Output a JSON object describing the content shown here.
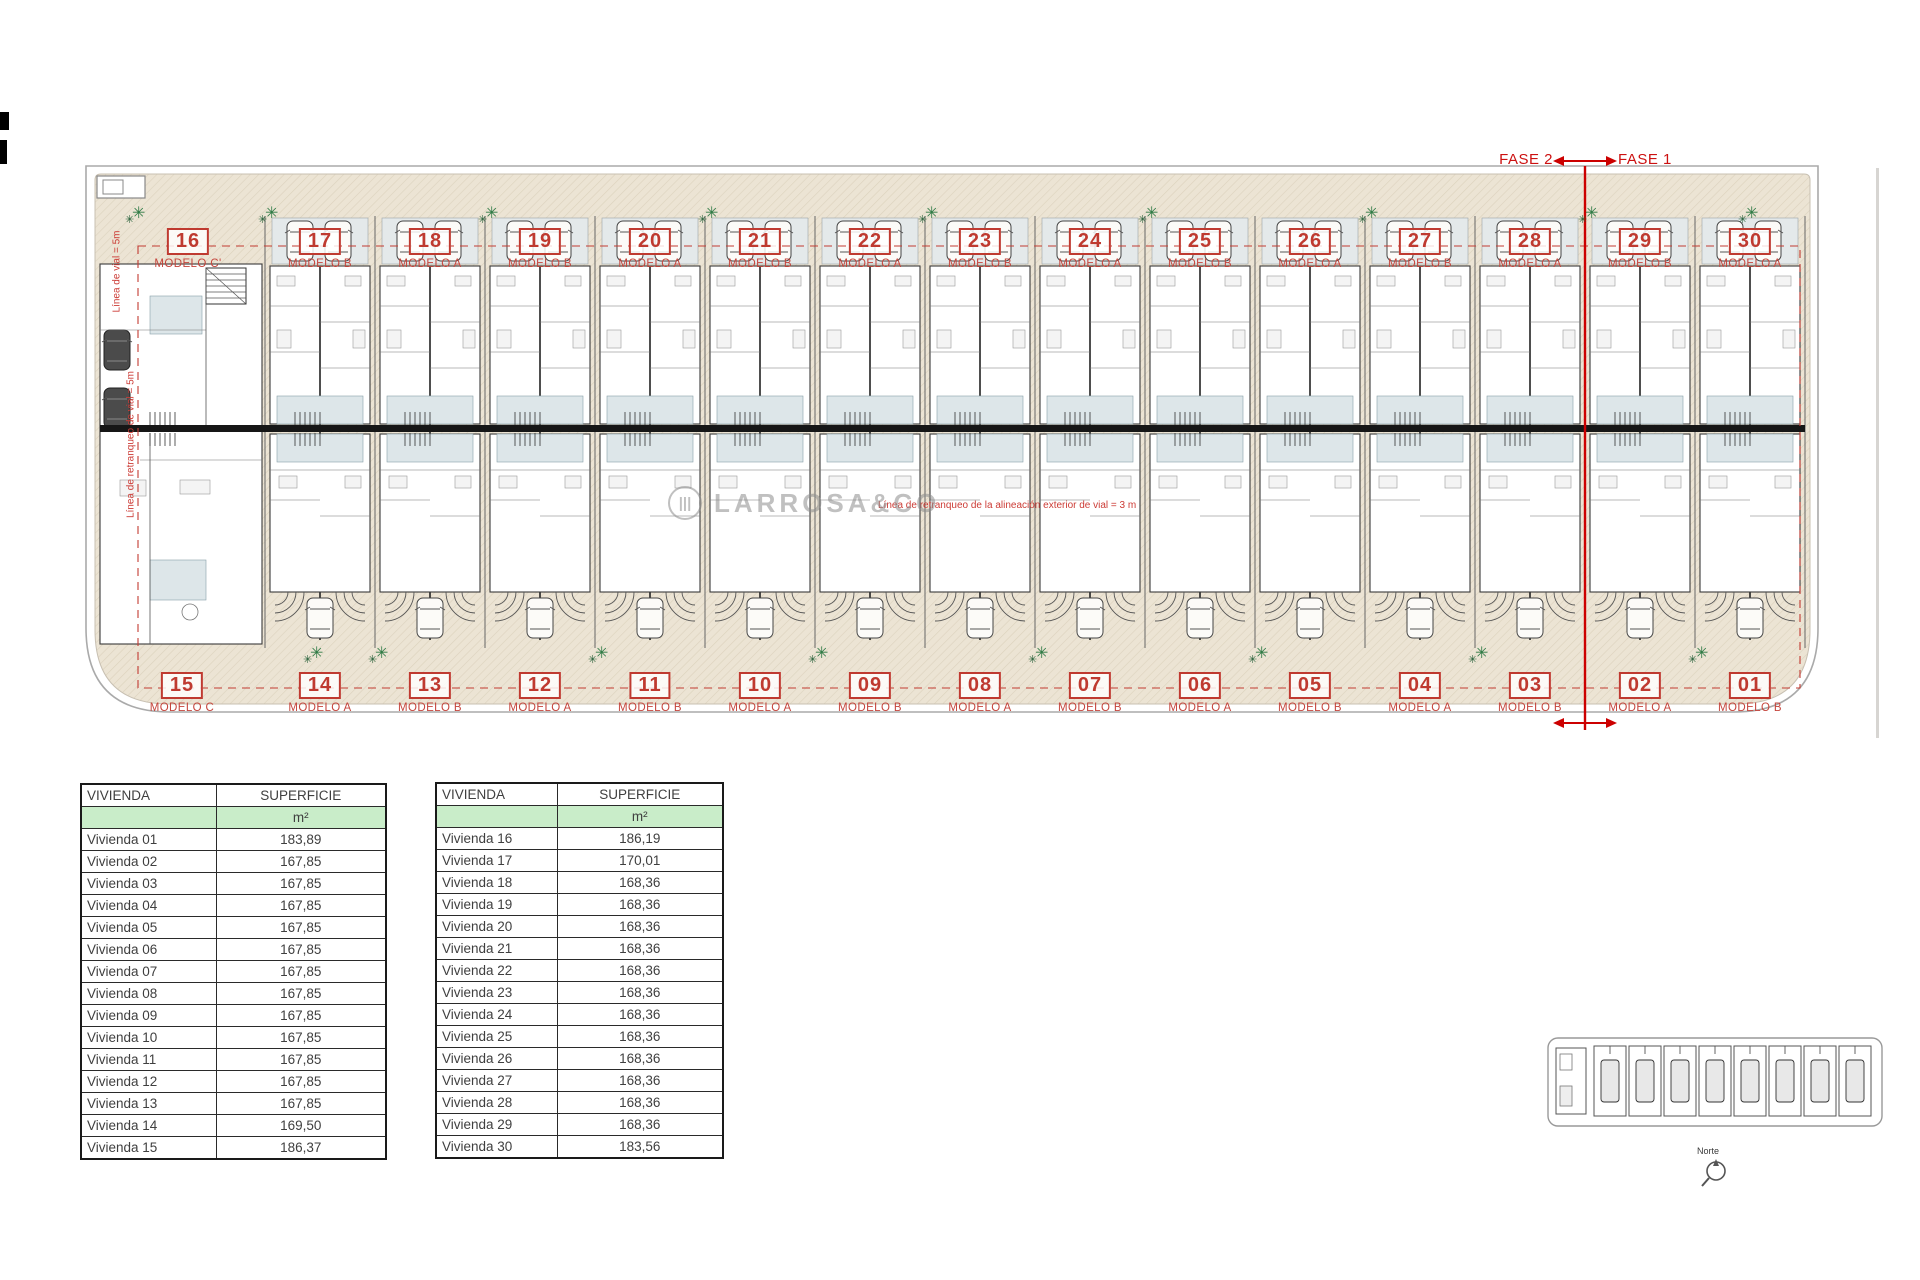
{
  "fase": {
    "left": "FASE 2",
    "right": "FASE 1"
  },
  "annotations": {
    "vial_top": "Línea de vial = 5m",
    "vial_left": "Línea de retranqueo de vial = 5m",
    "vial_mid": "Línea de retranqueo de la alineación exterior de vial = 3 m"
  },
  "watermark": {
    "text": "LARROSA&CO",
    "logo": "circle-logo"
  },
  "plan": {
    "top_units": [
      {
        "num": "16",
        "modelo": "MODELO C'"
      },
      {
        "num": "17",
        "modelo": "MODELO B"
      },
      {
        "num": "18",
        "modelo": "MODELO A"
      },
      {
        "num": "19",
        "modelo": "MODELO B"
      },
      {
        "num": "20",
        "modelo": "MODELO A"
      },
      {
        "num": "21",
        "modelo": "MODELO B"
      },
      {
        "num": "22",
        "modelo": "MODELO A"
      },
      {
        "num": "23",
        "modelo": "MODELO B"
      },
      {
        "num": "24",
        "modelo": "MODELO A"
      },
      {
        "num": "25",
        "modelo": "MODELO B"
      },
      {
        "num": "26",
        "modelo": "MODELO A"
      },
      {
        "num": "27",
        "modelo": "MODELO B"
      },
      {
        "num": "28",
        "modelo": "MODELO A"
      },
      {
        "num": "29",
        "modelo": "MODELO B"
      },
      {
        "num": "30",
        "modelo": "MODELO A"
      }
    ],
    "bottom_units": [
      {
        "num": "15",
        "modelo": "MODELO C"
      },
      {
        "num": "14",
        "modelo": "MODELO A"
      },
      {
        "num": "13",
        "modelo": "MODELO B"
      },
      {
        "num": "12",
        "modelo": "MODELO A"
      },
      {
        "num": "11",
        "modelo": "MODELO B"
      },
      {
        "num": "10",
        "modelo": "MODELO A"
      },
      {
        "num": "09",
        "modelo": "MODELO B"
      },
      {
        "num": "08",
        "modelo": "MODELO A"
      },
      {
        "num": "07",
        "modelo": "MODELO B"
      },
      {
        "num": "06",
        "modelo": "MODELO A"
      },
      {
        "num": "05",
        "modelo": "MODELO B"
      },
      {
        "num": "04",
        "modelo": "MODELO A"
      },
      {
        "num": "03",
        "modelo": "MODELO B"
      },
      {
        "num": "02",
        "modelo": "MODELO A"
      },
      {
        "num": "01",
        "modelo": "MODELO B"
      }
    ]
  },
  "tables": [
    {
      "col1": "VIVIENDA",
      "col2": "SUPERFICIE",
      "unit": "m²",
      "rows": [
        [
          "Vivienda 01",
          "183,89"
        ],
        [
          "Vivienda 02",
          "167,85"
        ],
        [
          "Vivienda 03",
          "167,85"
        ],
        [
          "Vivienda 04",
          "167,85"
        ],
        [
          "Vivienda 05",
          "167,85"
        ],
        [
          "Vivienda 06",
          "167,85"
        ],
        [
          "Vivienda 07",
          "167,85"
        ],
        [
          "Vivienda 08",
          "167,85"
        ],
        [
          "Vivienda 09",
          "167,85"
        ],
        [
          "Vivienda 10",
          "167,85"
        ],
        [
          "Vivienda 11",
          "167,85"
        ],
        [
          "Vivienda 12",
          "167,85"
        ],
        [
          "Vivienda 13",
          "167,85"
        ],
        [
          "Vivienda 14",
          "169,50"
        ],
        [
          "Vivienda 15",
          "186,37"
        ]
      ]
    },
    {
      "col1": "VIVIENDA",
      "col2": "SUPERFICIE",
      "unit": "m²",
      "rows": [
        [
          "Vivienda 16",
          "186,19"
        ],
        [
          "Vivienda 17",
          "170,01"
        ],
        [
          "Vivienda 18",
          "168,36"
        ],
        [
          "Vivienda 19",
          "168,36"
        ],
        [
          "Vivienda 20",
          "168,36"
        ],
        [
          "Vivienda 21",
          "168,36"
        ],
        [
          "Vivienda 22",
          "168,36"
        ],
        [
          "Vivienda 23",
          "168,36"
        ],
        [
          "Vivienda 24",
          "168,36"
        ],
        [
          "Vivienda 25",
          "168,36"
        ],
        [
          "Vivienda 26",
          "168,36"
        ],
        [
          "Vivienda 27",
          "168,36"
        ],
        [
          "Vivienda 28",
          "168,36"
        ],
        [
          "Vivienda 29",
          "168,36"
        ],
        [
          "Vivienda 30",
          "183,56"
        ]
      ]
    }
  ],
  "keyplan": {
    "north_label": "Norte"
  },
  "colors": {
    "accent_red": "#bf3a30",
    "phase_red": "#cc1111",
    "table_green": "#c9edc9",
    "paving": "#ece4d4",
    "plant_green": "#2e7a44"
  }
}
